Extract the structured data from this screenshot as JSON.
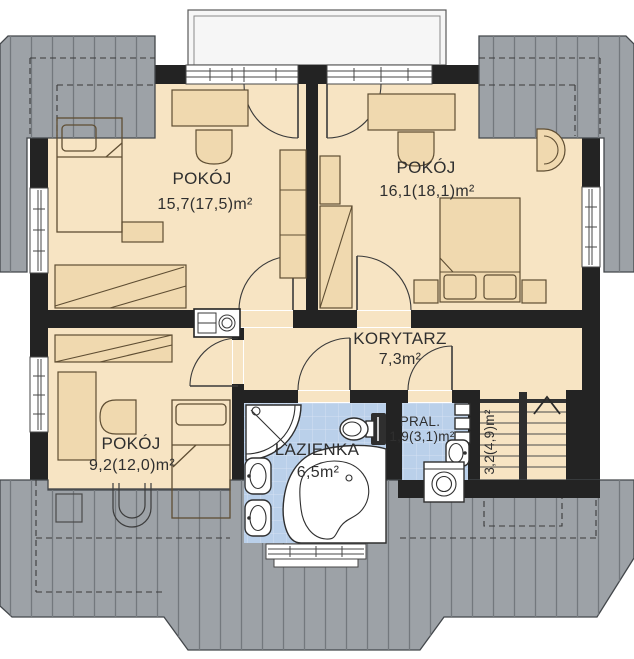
{
  "plan": {
    "rooms": [
      {
        "key": "pokoj-1",
        "name": "POKÓJ",
        "area": "15,7(17,5)m²"
      },
      {
        "key": "pokoj-2",
        "name": "POKÓJ",
        "area": "16,1(18,1)m²"
      },
      {
        "key": "korytarz",
        "name": "KORYTARZ",
        "area": "7,3m²"
      },
      {
        "key": "pokoj-3",
        "name": "POKÓJ",
        "area": "9,2(12,0)m²"
      },
      {
        "key": "lazienka",
        "name": "ŁAZIENKA",
        "area": "6,5m²"
      },
      {
        "key": "pralnia",
        "name": "PRAL.",
        "area": "1,9(3,1)m²"
      },
      {
        "key": "schody",
        "name": "",
        "area": "3,2(4,9)m²"
      }
    ],
    "icons": {
      "stairs_arrow": "chevron-up",
      "bathroom_fixtures": [
        "shower",
        "toilet",
        "washbasin",
        "washbasin",
        "corner-bathtub"
      ],
      "laundry_fixtures": [
        "washbasin",
        "washing-machine",
        "wall-shelves"
      ],
      "hallway_fixture": "water-heater",
      "roof_fixture": "roof-window"
    },
    "colors": {
      "roof": "#9da2a7",
      "roof_hatch": "#73787d",
      "wall": "#232323",
      "floor": "#f7e4c3",
      "furniture": "#f0d9af",
      "tile": "#bad0ea",
      "tile_grid": "#d4e1f3",
      "fixture": "#ffffff",
      "balcony": "#f6f6f6",
      "text": "#2f2f2f"
    }
  }
}
